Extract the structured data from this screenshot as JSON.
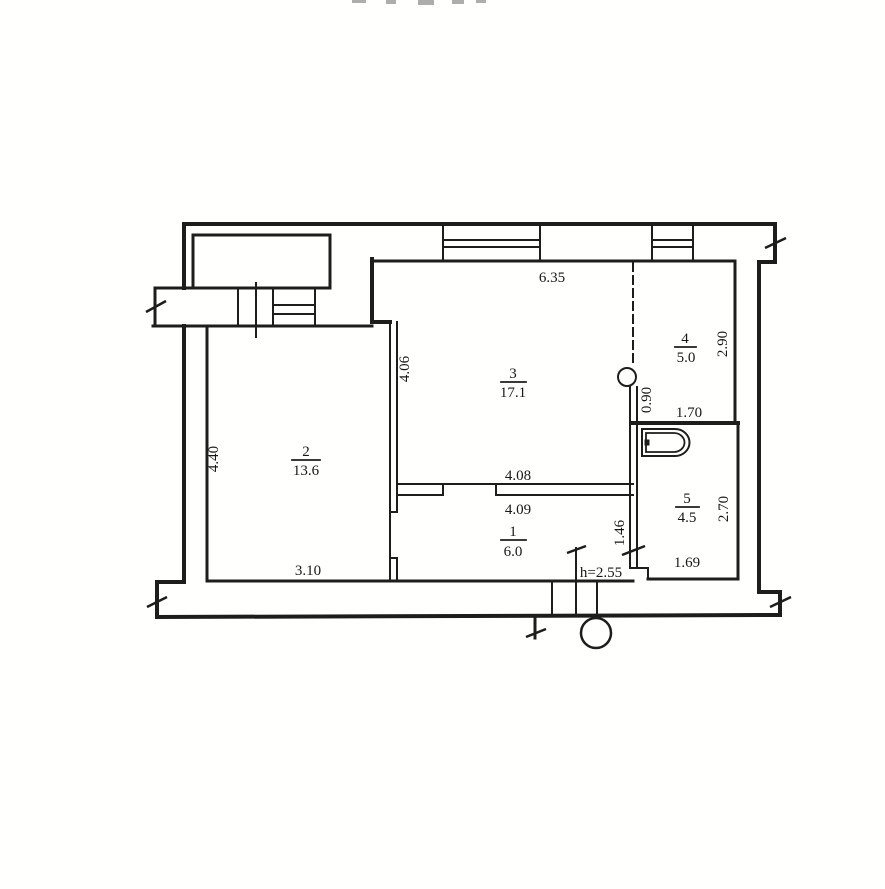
{
  "colors": {
    "ink": "#1d1d1b",
    "paper": "#fffffe"
  },
  "rooms": [
    {
      "number": "1",
      "area": "6.0"
    },
    {
      "number": "2",
      "area": "13.6"
    },
    {
      "number": "3",
      "area": "17.1"
    },
    {
      "number": "4",
      "area": "5.0"
    },
    {
      "number": "5",
      "area": "4.5"
    }
  ],
  "dimensions": {
    "top_width": "6.35",
    "room3_left_height": "4.06",
    "room2_left_height": "4.40",
    "room2_bottom_width": "3.10",
    "room3_bottom_width": "4.08",
    "room1_top_width": "4.09",
    "room1_right_height": "1.46",
    "room4_right_height": "2.90",
    "duct_wall_height": "0.90",
    "bath_wall_width": "1.70",
    "room5_right_height": "2.70",
    "room5_bottom_width": "1.69",
    "ceiling_height_note": "h=2.55"
  }
}
